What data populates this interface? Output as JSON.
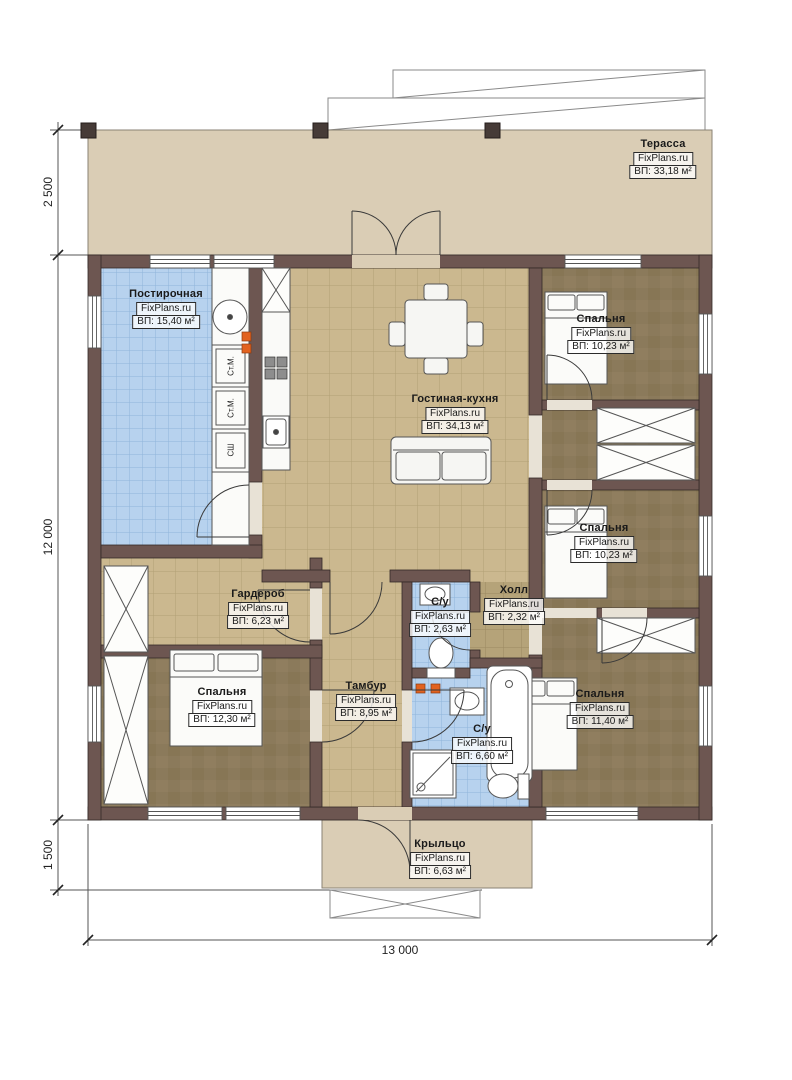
{
  "site": "FixPlans.ru",
  "rooms": {
    "terrace": {
      "name": "Терасса",
      "area": "ВП: 33,18 м²"
    },
    "laundry": {
      "name": "Постирочная",
      "area": "ВП: 15,40 м²"
    },
    "bedroom_tr": {
      "name": "Спальня",
      "area": "ВП: 10,23 м²"
    },
    "living": {
      "name": "Гостиная-кухня",
      "area": "ВП: 34,13 м²"
    },
    "bedroom_mr": {
      "name": "Спальня",
      "area": "ВП: 10,23 м²"
    },
    "wardrobe": {
      "name": "Гардероб",
      "area": "ВП: 6,23 м²"
    },
    "hall": {
      "name": "Холл",
      "area": "ВП: 2,32 м²"
    },
    "wc_small": {
      "name": "С/у",
      "area": "ВП: 2,63 м²"
    },
    "bedroom_bl": {
      "name": "Спальня",
      "area": "ВП: 12,30 м²"
    },
    "vestibule": {
      "name": "Тамбур",
      "area": "ВП: 8,95 м²"
    },
    "wc_big": {
      "name": "С/у",
      "area": "ВП: 6,60 м²"
    },
    "bedroom_br": {
      "name": "Спальня",
      "area": "ВП: 11,40 м²"
    },
    "porch": {
      "name": "Крыльцо",
      "area": "ВП: 6,63 м²"
    }
  },
  "dimensions": {
    "terrace_depth": "2 500",
    "house_depth": "12 000",
    "porch_depth": "1 500",
    "house_width": "13 000"
  },
  "appliances": {
    "washer1": "Ст.М.",
    "washer2": "Ст.М.",
    "dryer": "СШ"
  },
  "colors": {
    "wall": "#6d5651",
    "terrace_floor": "#dacdb5",
    "tan_tile": "#cbb88f",
    "blue_tile": "#b7d2ee",
    "brown_floor": "#8b7a5b",
    "hall_tile": "#b5a379",
    "outlet": "#e2621f"
  }
}
